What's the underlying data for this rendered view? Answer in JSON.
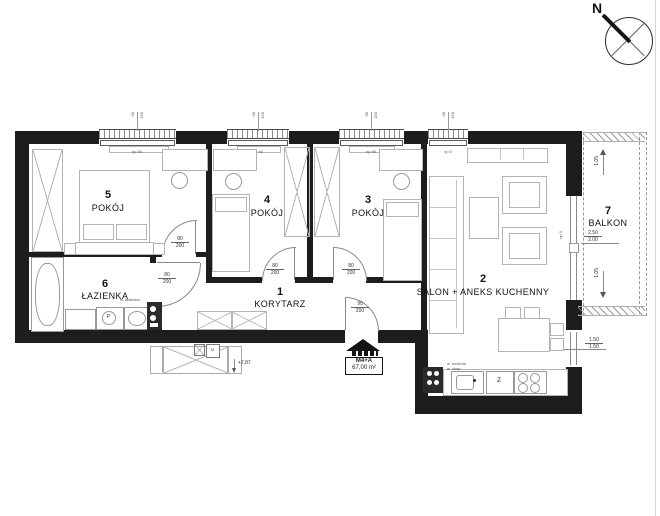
{
  "compass": {
    "north": "N"
  },
  "rooms": {
    "r5": {
      "num": "5",
      "name": "POKÓJ"
    },
    "r4": {
      "num": "4",
      "name": "POKÓJ"
    },
    "r3": {
      "num": "3",
      "name": "POKÓJ"
    },
    "r6": {
      "num": "6",
      "name": "ŁAZIENKA"
    },
    "r1": {
      "num": "1",
      "name": "KORYTARZ"
    },
    "r2": {
      "num": "2",
      "name": "SALON + ANEKS KUCHENNY"
    },
    "r7": {
      "num": "7",
      "name": "BALKON"
    }
  },
  "badge": {
    "unit": "M4+A",
    "area": "67,00 m²"
  },
  "dims": {
    "level": "+2,87",
    "balcony_depth": "1.05",
    "balcony_door_width": "2.50",
    "balcony_door_width_b": "2.00",
    "side_window_width": "1.50",
    "side_window_width_b": "1.50",
    "door_width": "80",
    "door_height": "200",
    "entry_door_width": "90",
    "entry_door_height": "200",
    "window_tag": "np 90",
    "window_tag_zero": "np 0",
    "window_dim_a": "90",
    "window_dim_b": "150"
  },
  "marks": {
    "washer": "P",
    "dishwasher": "Z",
    "meter": "M",
    "vent_kitchen": "w. kuchnia",
    "vent_hood": "w. okap",
    "vent_bath": "w. łazienka"
  }
}
